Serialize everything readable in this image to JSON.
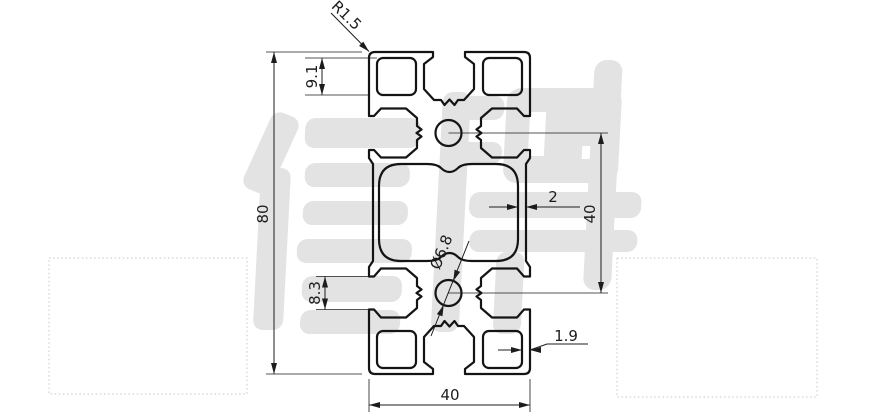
{
  "drawing": {
    "kind": "aluminium-extrusion-profile-cross-section",
    "watermark": {
      "text": "信牌",
      "color": "#e3e3e3"
    },
    "colors": {
      "line": "#141414",
      "dimension": "#1c1c1c",
      "frame_dotted": "#c7c7c7",
      "background": "#ffffff"
    },
    "dimensions": {
      "corner_radius_label": "R1.5",
      "slot_chamber_height_label": "9.1",
      "overall_height_label": "80",
      "mid_wall_thickness_label": "2",
      "core_distance_label": "40",
      "core_hole_diameter_label": "Ø6.8",
      "side_slot_opening_label": "8.3",
      "chamber_wall_thickness_label": "1.9",
      "overall_width_label": "40"
    }
  }
}
